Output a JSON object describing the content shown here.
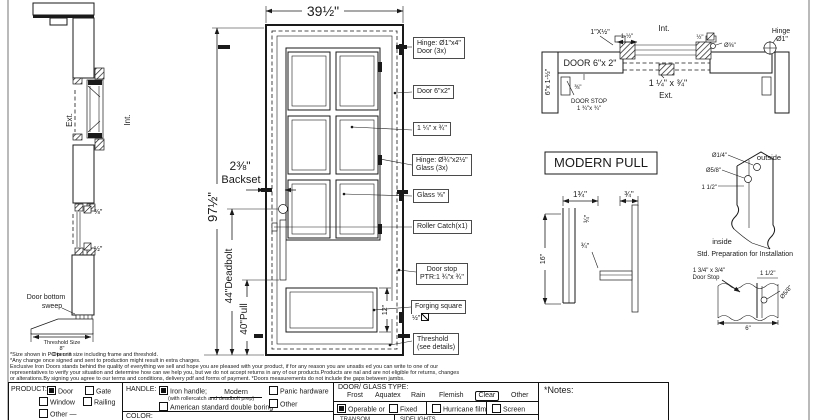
{
  "jamb_section": {
    "ext": "Ext.",
    "int": "Int.",
    "glass_38": "⅜\"",
    "glass_12": "½\"",
    "sweep1": "Door bottom",
    "sweep2": "sweep",
    "threshold_size": "Threshold Size",
    "threshold_value": "8\"",
    "open_in": "Open in"
  },
  "elevation": {
    "width": "39½\"",
    "height": "97½\"",
    "backset_value": "2⅜\"",
    "backset_word": "Backset",
    "deadbolt": "44\"Deadbolt",
    "pull": "40\"Pull",
    "panel": "12\"",
    "callout_hinge_door_1": "Hinge: Ø1\"x4\"",
    "callout_hinge_door_2": "Door (3x)",
    "callout_door": "Door  6\"x2\"",
    "callout_muntin": "1 ¼\" x ¾\"",
    "callout_hinge_glass_1": "Hinge: Ø¾\"x2½\"",
    "callout_hinge_glass_2": "Glass (3x)",
    "callout_glass": "Glass ⅝\"",
    "callout_roller": "Roller Catch(x1)",
    "callout_doorstop_1": "Door stop",
    "callout_doorstop_2": "PTR:1 ¾\"x ¾\"",
    "callout_forging": "Forging square",
    "callout_forging_dim": "½\"",
    "callout_threshold_1": "Threshold",
    "callout_threshold_2": "(see details)"
  },
  "head_section": {
    "dim_1xhalf": "1\"X½\"",
    "dim_1half": "1-½\"",
    "int": "Int.",
    "dim_half": "½\"",
    "dia_58": "Ø⅝\"",
    "hinge_1": "Hinge",
    "hinge_2": "Ø1\"",
    "door_6x2": "DOOR 6\"x 2\"",
    "jamb_6x112": "6\"x 1-½\"",
    "dim_38": "⅜\"",
    "door_stop_1": "DOOR STOP",
    "door_stop_2": "1 ¾\"x ¾\"",
    "dim_114x34": "1 ¼\" x ¾\"",
    "ext": "Ext."
  },
  "modern_pull": {
    "title": "MODERN PULL",
    "dim_134": "1¾\"",
    "dim_34_a": "¾\"",
    "dim_34_b": "¾\"",
    "dim_34_c": "¾\"",
    "dim_16": "16\""
  },
  "installation": {
    "dia_14": "Ø1/4\"",
    "dia_58": "Ø5/8\"",
    "dim_112": "1 1/2\"",
    "outside": "outside",
    "inside": "inside",
    "caption": "Std. Preparation for Installation"
  },
  "doorstop_detail": {
    "label_1": "1 3/4\" x 3/4\"",
    "label_2": "Door Stop",
    "dim_112": "1 1/2\"",
    "dia_58": "Ø5/8\"",
    "dim_6": "6\""
  },
  "disclaimer": {
    "line1": "*Size shown in PO is unit size including frame and threshold.",
    "line2": "*Any change once signed and sent to production might result in extra charges.",
    "line3": "Exclusive Iron Doors stands behind the quality of everything we sell and hope you are pleased with your product, if for any reason you are unsatis  ed you can write to one of our",
    "line4": "representatives to verify your situation and determine how can we help you, but we do not accept returns in any of our products.Products are   nal and are not eligible for returns, changes",
    "line5": "or alterations.By signing you agree to our terms and conditions, delivery pdf and forms of payment. *Doors measurements do not include the gaps between jambs."
  },
  "form": {
    "product_label": "PRODUCT:",
    "product_door": "Door",
    "product_gate": "Gate",
    "product_window": "Window",
    "product_railing": "Railing",
    "product_other": "Other",
    "product_other_suffix": "—",
    "handle_label": "HANDLE:",
    "handle_iron": "Iron handle;",
    "handle_iron_model": "Modern",
    "handle_iron_note": "(with rollercatch and deadbolt prep)",
    "handle_asdb": "American standard double boring",
    "handle_panic": "Panic hardware",
    "handle_other": "Other",
    "color_label": "COLOR:",
    "glass_header": "DOOR/ GLASS TYPE:",
    "glass_frost": "Frost",
    "glass_aquatex": "Aquatex",
    "glass_rain": "Rain",
    "glass_flemish": "Flemish",
    "glass_clear": "Clear",
    "glass_other": "Other",
    "operable": "Operable  or",
    "fixed": "Fixed",
    "hurricane": "Hurricane film",
    "screen": "Screen",
    "transom": "TRANSOM",
    "sidelights": "SIDELIGHTS",
    "notes_label": "*Notes:",
    "checks": {
      "product_door": true,
      "product_gate": false,
      "product_window": false,
      "product_railing": false,
      "product_other": false,
      "handle_iron": true,
      "handle_asdb": false,
      "handle_panic": false,
      "handle_other": false,
      "operable": true,
      "fixed": false,
      "hurricane": false,
      "screen": false
    }
  }
}
